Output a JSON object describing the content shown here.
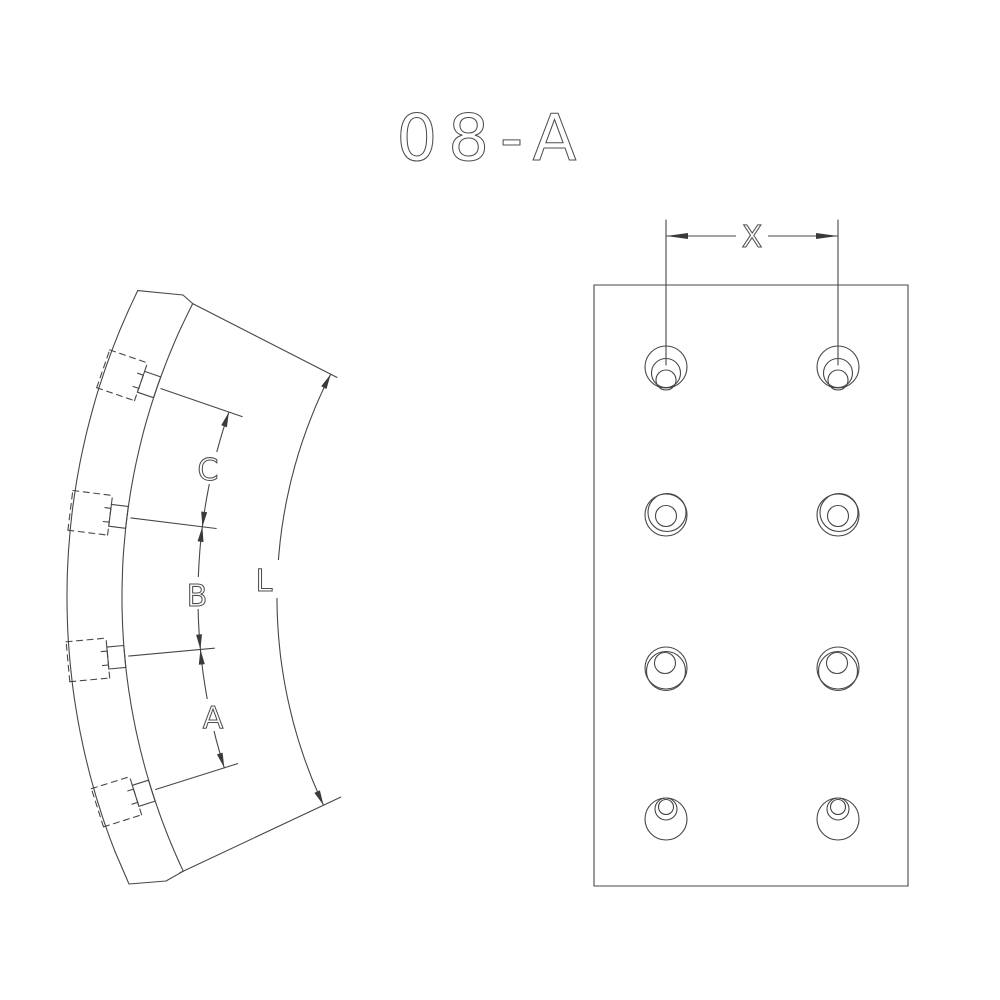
{
  "title": "08-A",
  "colors": {
    "line": "#474747",
    "background": "#ffffff",
    "arrow": "#3a3a3a"
  },
  "side_view": {
    "rivet_hole_count": 4,
    "labels": {
      "spacing_top": "C",
      "spacing_middle": "B",
      "spacing_bottom": "A",
      "arc_length": "L"
    }
  },
  "face_view": {
    "hole_columns": 2,
    "hole_rows": 4,
    "labels": {
      "hole_column_spacing": "X"
    }
  }
}
